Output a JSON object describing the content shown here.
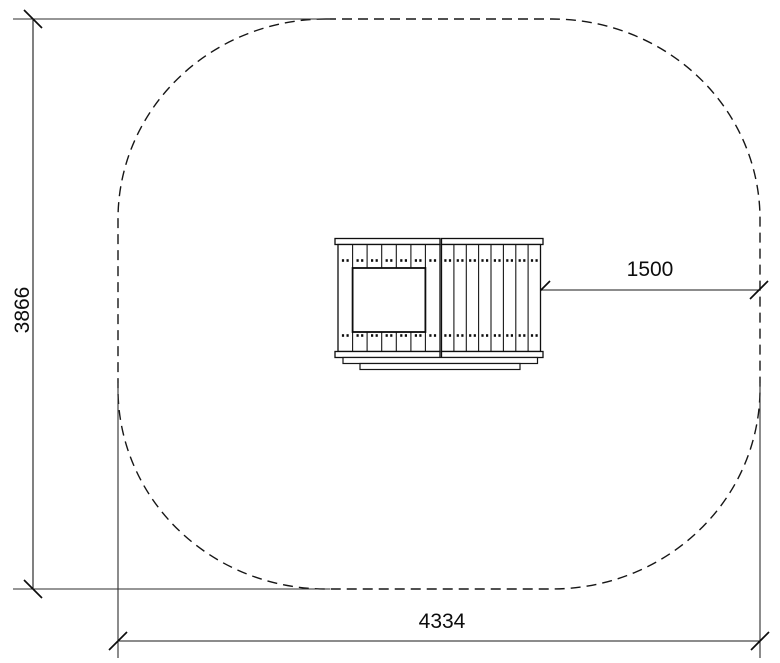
{
  "canvas": {
    "background": "#ffffff",
    "ink": "#111111"
  },
  "dimensions": {
    "height": {
      "value": "3866",
      "orientation": "vertical",
      "side": "left"
    },
    "width": {
      "value": "4334",
      "orientation": "horizontal",
      "side": "bottom"
    },
    "clearance": {
      "value": "1500",
      "orientation": "horizontal",
      "side": "center-right"
    }
  },
  "safety_zone": {
    "outline_style": "dashed",
    "shape": "rounded-rectangle"
  },
  "equipment": {
    "view": "top-plan",
    "left_planks": 7,
    "right_planks": 8,
    "has_opening": true
  }
}
